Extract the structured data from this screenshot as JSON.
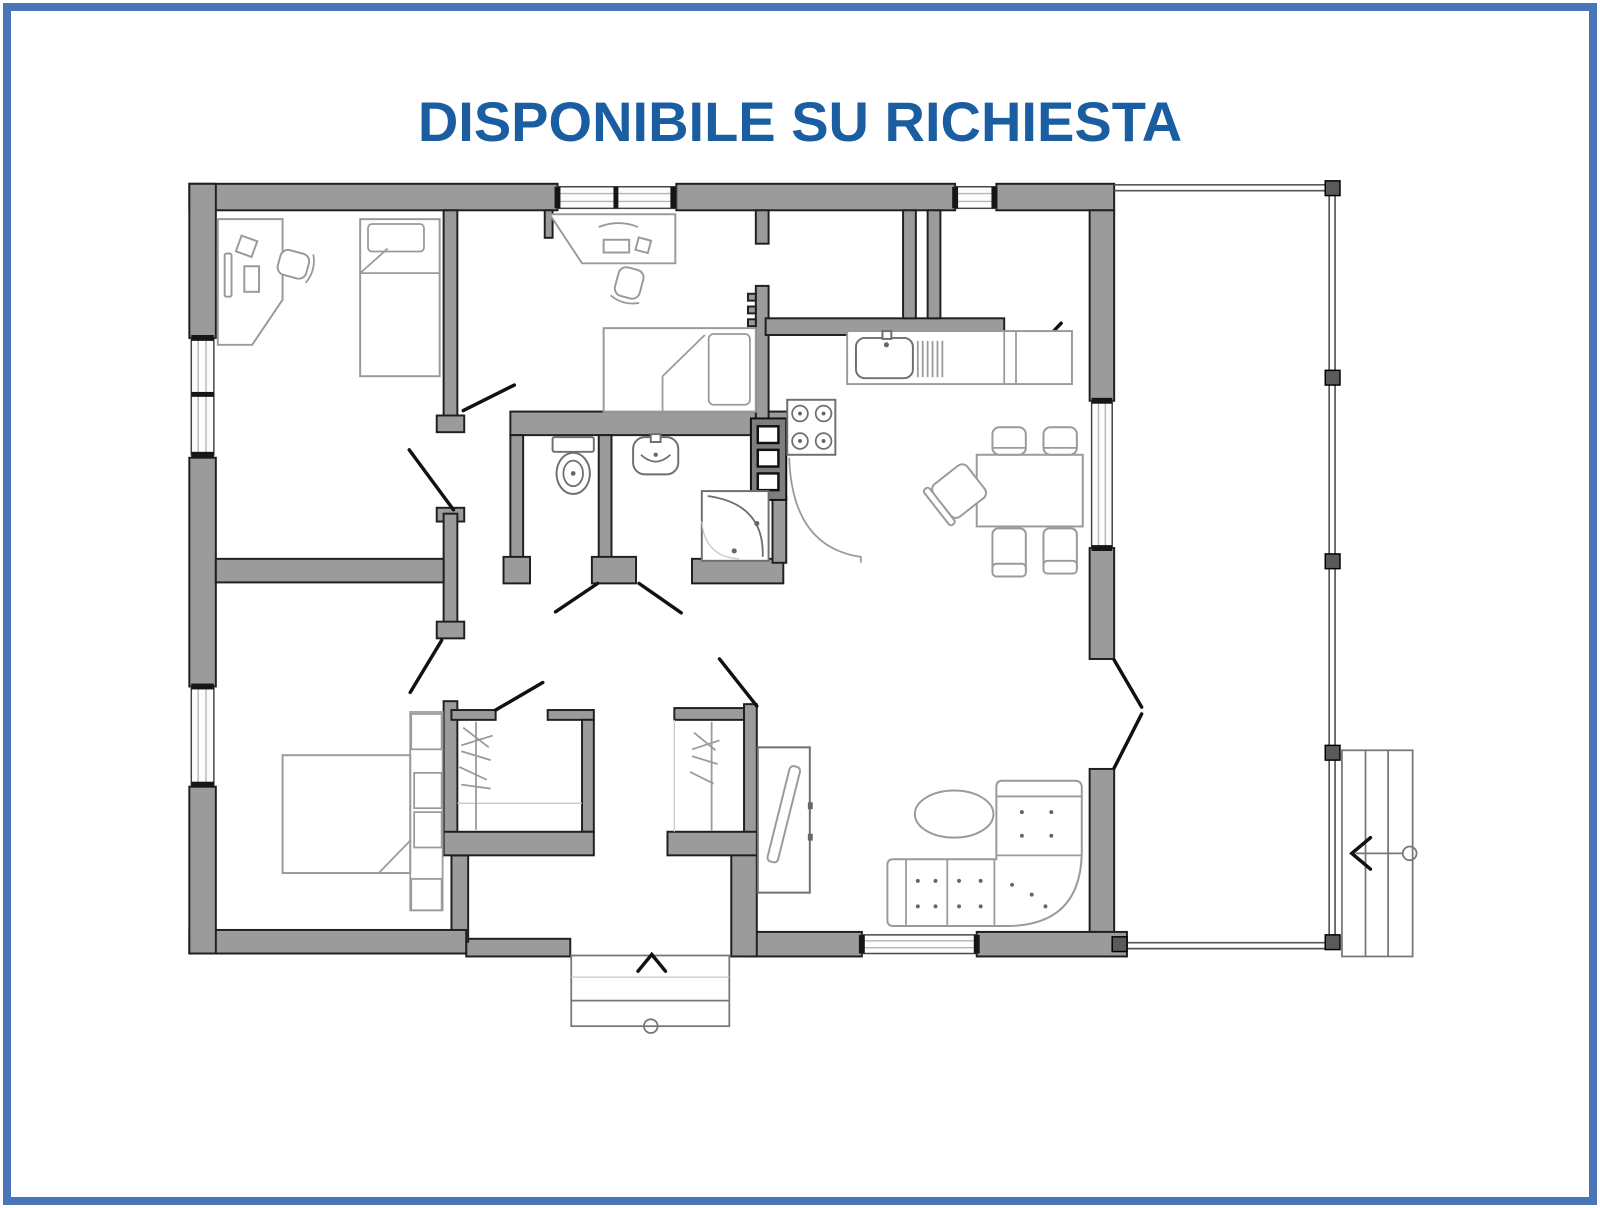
{
  "title": {
    "text": "DISPONIBILE SU RICHIESTA"
  },
  "colors": {
    "frame_border": "#4A74B8",
    "title_text": "#1A5DA1",
    "background": "#FFFFFF",
    "wall_fill": "#9B9B9B",
    "wall_stroke": "#1F1F1F",
    "furniture_line": "#9A9A9A",
    "appliance_line": "#6F6F6F",
    "door_color": "#111111",
    "terrace_line": "#555555"
  },
  "floor_plan": {
    "kind": "residential-floor-plan-top-view",
    "rooms": [
      {
        "name": "bedroom-office",
        "position": "top-left",
        "features": [
          "corner-desk",
          "monitor",
          "desk-lamp",
          "keyboard",
          "office-chair",
          "single-bed"
        ]
      },
      {
        "name": "bedroom-2",
        "position": "top-center",
        "features": [
          "desk",
          "monitor",
          "keyboard",
          "office-chair",
          "single-bed"
        ]
      },
      {
        "name": "storage-rooms",
        "position": "top-right-of-center",
        "features": []
      },
      {
        "name": "wc",
        "position": "center",
        "features": [
          "toilet"
        ]
      },
      {
        "name": "bathroom",
        "position": "center",
        "features": [
          "washbasin",
          "corner-shower"
        ]
      },
      {
        "name": "kitchen",
        "position": "center-right",
        "features": [
          "sink-counter",
          "drainer",
          "four-burner-stove",
          "boiler-unit",
          "curved-counter"
        ]
      },
      {
        "name": "dining-area",
        "position": "right",
        "features": [
          "dining-table",
          "five-chairs"
        ]
      },
      {
        "name": "living-room",
        "position": "bottom-right",
        "features": [
          "corner-sofa",
          "oval-coffee-table",
          "tv-sideboard",
          "french-door-to-terrace"
        ]
      },
      {
        "name": "master-bedroom",
        "position": "bottom-left",
        "features": [
          "double-bed",
          "headboard-shelf-column"
        ]
      },
      {
        "name": "hallway",
        "position": "bottom-center",
        "features": [
          "wardrobe-left",
          "wardrobe-right"
        ]
      },
      {
        "name": "entrance",
        "position": "bottom-center",
        "features": [
          "entry-steps",
          "entry-direction-arrow"
        ]
      },
      {
        "name": "terrace",
        "position": "right",
        "features": [
          "support-posts"
        ]
      },
      {
        "name": "external-stairs",
        "position": "far-right",
        "features": [
          "three-steps",
          "direction-arrow",
          "start-circle"
        ]
      }
    ]
  }
}
